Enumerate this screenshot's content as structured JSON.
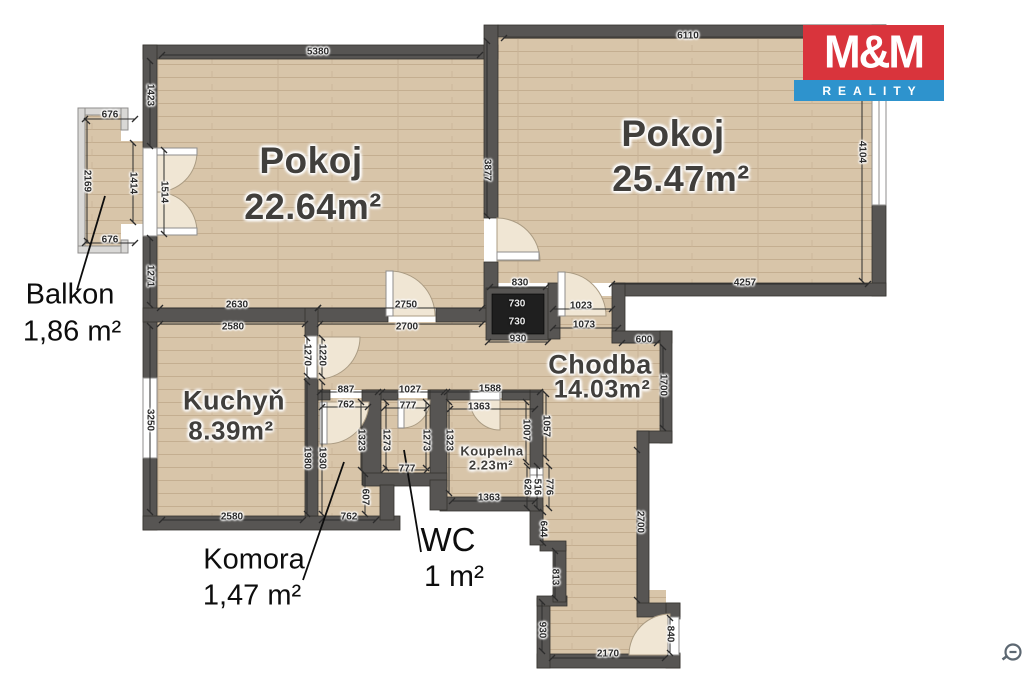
{
  "logo": {
    "line1": "M&M",
    "line2": "REALITY"
  },
  "rooms": {
    "pokoj1": {
      "name": "Pokoj",
      "area": "22.64m²"
    },
    "pokoj2": {
      "name": "Pokoj",
      "area": "25.47m²"
    },
    "kuchyn": {
      "name": "Kuchyň",
      "area": "8.39m²"
    },
    "chodba": {
      "name": "Chodba",
      "area": "14.03m²"
    },
    "koupelna": {
      "name": "Koupelna",
      "area": "2.23m²"
    },
    "balkon": {
      "name": "Balkon",
      "area": "1,86 m²"
    },
    "komora": {
      "name": "Komora",
      "area": "1,47 m²"
    },
    "wc": {
      "name": "WC",
      "area": "1 m²"
    }
  },
  "shaft": {
    "top": "730",
    "bottom": "730"
  },
  "dims": {
    "pokoj1_top": "5380",
    "pokoj1_left_upper": "1423",
    "pokoj1_left_lower": "1271",
    "pokoj1_bottom_left": "2630",
    "pokoj1_bottom_right": "2750",
    "balkon_top": "676",
    "balkon_bottom": "676",
    "balkon_left": "2169",
    "balkon_right": "1414",
    "balkon_door": "1514",
    "divider": "3877",
    "pokoj2_top": "6110",
    "pokoj2_right": "4104",
    "pokoj2_bottom": "4257",
    "shaft_top": "830",
    "shaft_bottom": "930",
    "door_pokoj2": "1023",
    "hall_top": "1073",
    "step_top": "600",
    "chodba_right_upper": "1700",
    "chodba_right_lower": "2700",
    "kuchyn_top_left": "2580",
    "kuchyn_top_right": "2700",
    "kuchyn_left": "3250",
    "kuchyn_bottom": "2580",
    "kuchyn_door_left": "1270",
    "kuchyn_door_right": "1220",
    "kuchyn_right_lower": "1980",
    "komora_left": "1930",
    "komora_top": "887",
    "komora_top_inner": "762",
    "komora_right_upper": "1323",
    "komora_right_lower": "607",
    "komora_bottom": "762",
    "wc_top": "1027",
    "wc_top_inner": "777",
    "wc_left": "1273",
    "wc_right": "1273",
    "wc_bottom": "777",
    "koupelna_top": "1588",
    "koupelna_top_inner": "1363",
    "koupelna_left": "1323",
    "koupelna_right_inner": "1007",
    "koupelna_bottom": "1363",
    "chodba_left_upper": "1057",
    "seg_626": "626",
    "seg_516": "516",
    "koupelna_door": "776",
    "seg_644": "644",
    "seg_813": "813",
    "seg_930": "930",
    "entrance_bottom": "2170",
    "entrance_door": "840"
  },
  "colors": {
    "wall": "#575553",
    "floor": "#d8c5a9",
    "logo_red": "#d9343c",
    "logo_blue": "#2e93cd"
  }
}
